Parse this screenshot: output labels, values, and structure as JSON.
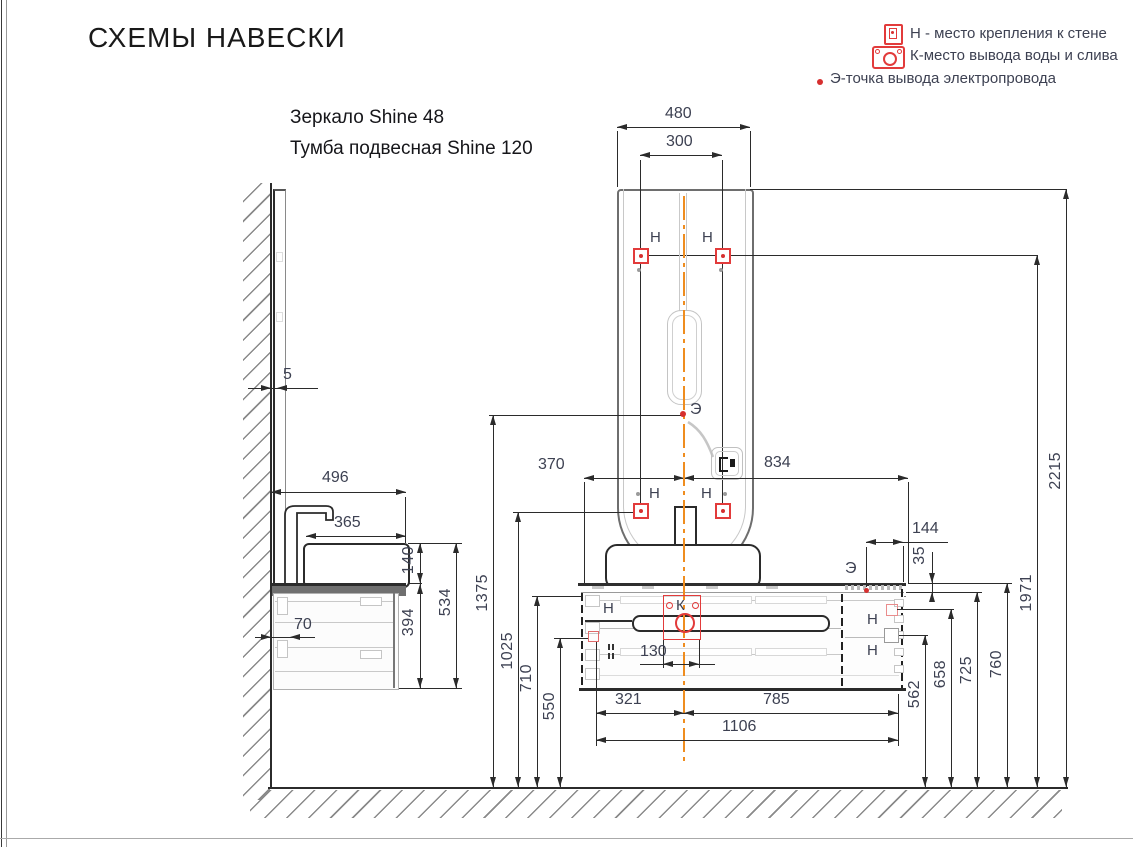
{
  "title": "СХЕМЫ НАВЕСКИ",
  "products": {
    "mirror": "Зеркало Shine 48",
    "cabinet": "Тумба подвесная Shine 120"
  },
  "legend": [
    {
      "key": "Н",
      "text": "Н - место крепления к стене"
    },
    {
      "key": "К",
      "text": "К-место вывода воды и слива"
    },
    {
      "key": "Э",
      "text": "Э-точка вывода электропровода"
    }
  ],
  "markers": {
    "wall_mount": "Н",
    "water_outlet": "К",
    "electric": "Э"
  },
  "dims": {
    "mirror_width": "480",
    "mirror_mount_span": "300",
    "mirror_wall_gap": "5",
    "span_left": "370",
    "span_right": "834",
    "e_offset": "144",
    "countertop_thickness": "35",
    "h_e_point": "1375",
    "h_mirror_mounts_low": "1025",
    "h_710": "710",
    "h_550": "550",
    "h_562": "562",
    "h_658": "658",
    "h_725": "725",
    "h_760": "760",
    "h_mirror_mounts_up": "1971",
    "h_mirror_top": "2215",
    "k_width": "130",
    "bottom_left": "321",
    "bottom_right": "785",
    "bottom_total": "1106",
    "side_depth": "496",
    "side_basin_depth": "365",
    "side_basin_height": "140",
    "side_cabinet_height": "394",
    "side_total_height": "534",
    "side_70": "70"
  },
  "colors": {
    "marker_red": "#e23b3b",
    "centerline_orange": "#ef8d1f",
    "dim_text": "#3d4152",
    "line": "#2b2b2b"
  }
}
